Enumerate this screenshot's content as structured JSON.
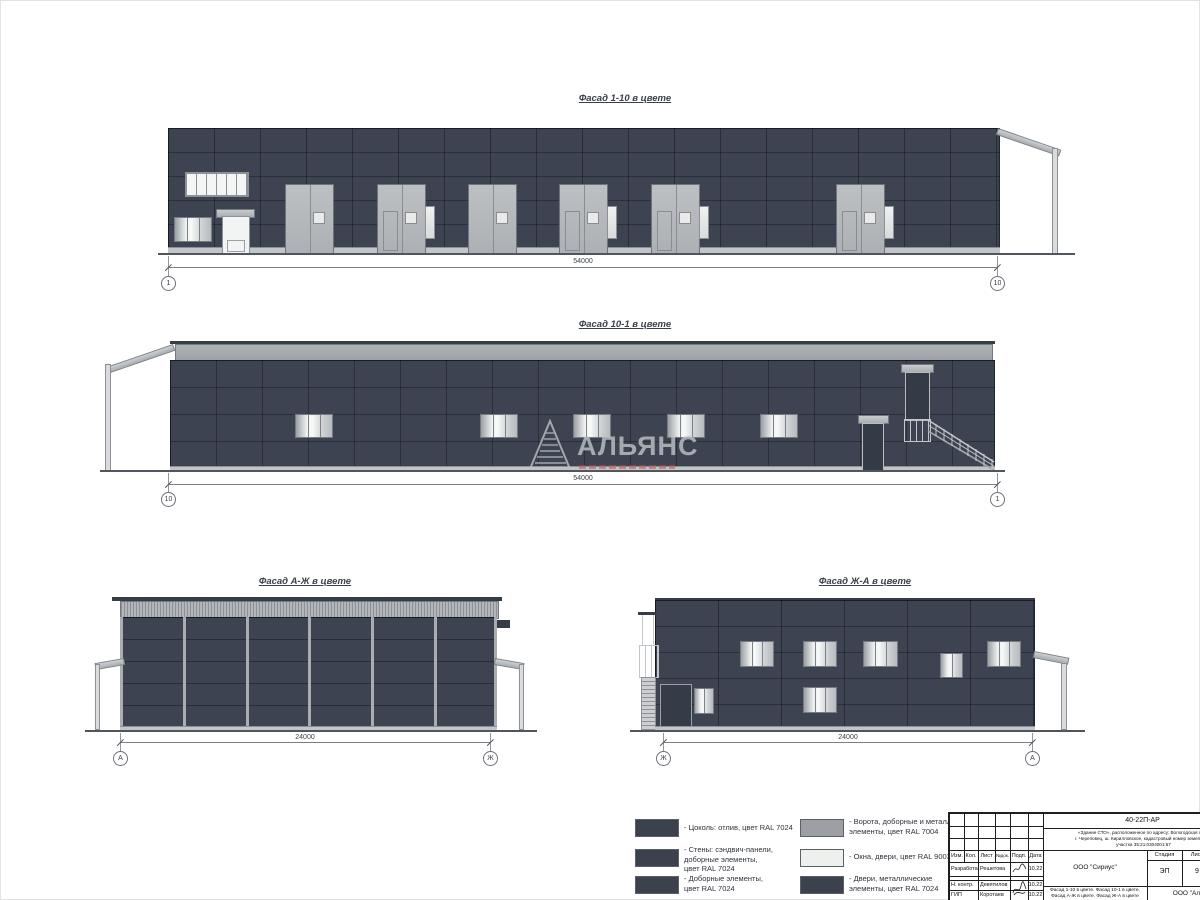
{
  "watermark": {
    "text": "АЛЬЯНС"
  },
  "colors": {
    "wall_ral7024": "#3d4350",
    "gate_ral7004": "#9ca0a4",
    "white_ral9003": "#eef0ed",
    "dark_swatch": "#3b414d"
  },
  "facades": [
    {
      "title": "Фасад 1-10 в цвете",
      "dim": "54000",
      "axis_left": "1",
      "axis_right": "10"
    },
    {
      "title": "Фасад 10-1 в цвете",
      "dim": "54000",
      "axis_left": "10",
      "axis_right": "1"
    },
    {
      "title": "Фасад А-Ж в цвете",
      "dim": "24000",
      "axis_left": "А",
      "axis_right": "Ж"
    },
    {
      "title": "Фасад Ж-А в цвете",
      "dim": "24000",
      "axis_left": "Ж",
      "axis_right": "А"
    }
  ],
  "legend": {
    "items_left": [
      {
        "swatch": "#3b414d",
        "lines": [
          "- Цоколь: отлив, цвет RAL 7024"
        ]
      },
      {
        "swatch": "#3b414d",
        "lines": [
          "- Стены: сэндвич-панели,",
          "доборные элементы,",
          "цвет RAL 7024"
        ]
      },
      {
        "swatch": "#3b414d",
        "lines": [
          "- Доборные элементы,",
          "цвет RAL 7024"
        ]
      }
    ],
    "items_right": [
      {
        "swatch": "#9ca0a4",
        "lines": [
          "- Ворота, доборные и металл.",
          "элементы, цвет RAL 7004"
        ]
      },
      {
        "swatch": "#eef0ed",
        "lines": [
          "- Окна, двери, цвет RAL 9003"
        ]
      },
      {
        "swatch": "#3b414d",
        "lines": [
          "- Двери, металлические",
          "элементы, цвет RAL 7024"
        ]
      }
    ]
  },
  "titleblock": {
    "doc_number": "40-22П-АР",
    "object_lines": [
      "«Здание СТО», расположенное по адресу: Вологодская обл.,",
      "г. Череповец, ш. Кирилловское, кадастровый номер земельного",
      "участка 35:21:0304001:67"
    ],
    "rev_header": [
      "Изм.",
      "Кол.",
      "Лист",
      "№док.",
      "Подп.",
      "Дата"
    ],
    "signers": [
      {
        "role": "Разработал",
        "name": "Решетова",
        "date": "10.22"
      },
      {
        "role": "Н. контр.",
        "name": "Девятилов",
        "date": "10.22"
      },
      {
        "role": "ГИП",
        "name": "Коротаев",
        "date": "10.22"
      }
    ],
    "client": "ООО \"Сириус\"",
    "stage_label": "Стадия",
    "sheet_label": "Лист",
    "sheets_label": "Листов",
    "stage": "ЭП",
    "sheet_no": "9",
    "sheet_title_lines": [
      "Фасад 1-10 в цвете. Фасад 10-1 в цвете.",
      "Фасад А-Ж в цвете. Фасад Ж-А в цвете"
    ],
    "org": "ООО \"Альянс\""
  }
}
